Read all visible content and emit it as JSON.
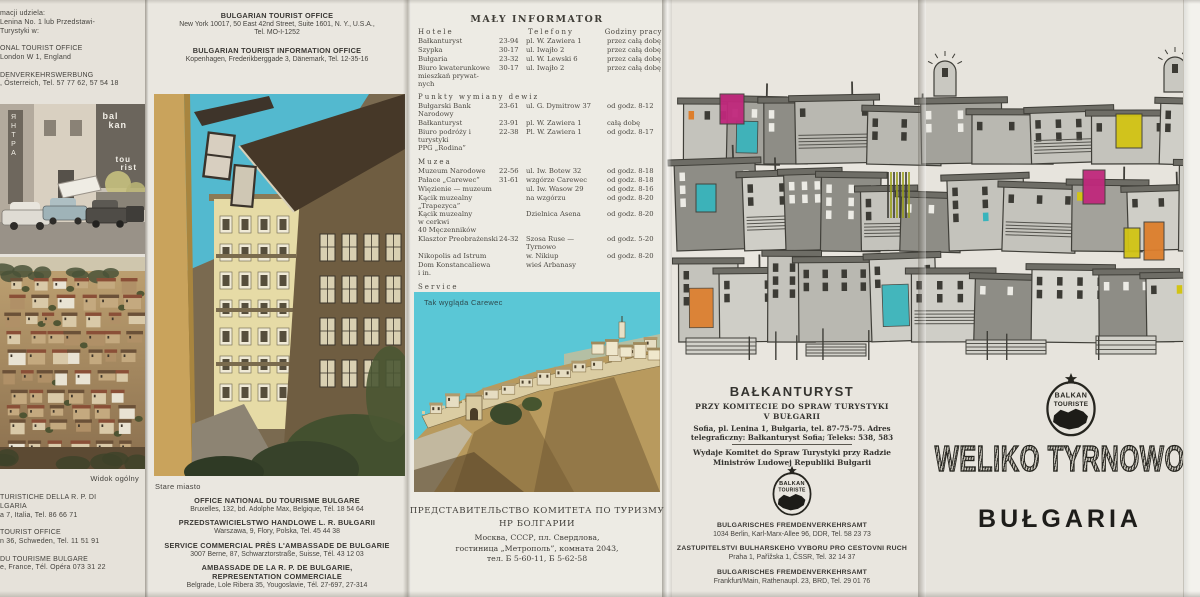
{
  "colors": {
    "paper": "#e8e5de",
    "ink": "#44423d",
    "magenta": "#c0287c",
    "yellow": "#d2c414",
    "orange": "#dd7e2c",
    "teal": "#38b4bc",
    "sky": "#58c5d4",
    "street_sky": "#53b9cf"
  },
  "logo": {
    "top": "BALKAN",
    "bottom": "TOURISTE"
  },
  "panel1": {
    "top_block": "macji udziela:\nLenina No. 1 lub Przedstawi-\nTurystyki w:\n\nONAL TOURIST OFFICE\nLondon W 1, England\n\nDENVERKEHRSWERBUNG\n, Österreich, Tel. 57 77 62, 57 54 18",
    "hotel_sign": {
      "vertical": "ЯНТРА",
      "line1": "bal",
      "line2": "kan",
      "line3": "tou",
      "line4": "rist"
    },
    "caption": "Widok ogólny",
    "bottom_block": "TURISTICHE DELLA R. P. DI\nLGARIA\na 7, Italia, Tel. 86 66 71\n\nTOURIST OFFICE\nn 36, Schweden, Tel. 11 51 91\n\nDU TOURISME BULGARE\ne, France, Tél. Opéra 073 31 22"
  },
  "panel2": {
    "top_offices": [
      {
        "title": "BULGARIAN TOURIST OFFICE",
        "lines": "New York 10017, 50 East 42nd Street, Suite 1601, N. Y., U.S.A.,\nTel. MO-I-1252"
      },
      {
        "title": "BULGARIAN TOURIST INFORMATION OFFICE",
        "lines": "Kopenhagen, Frederikberggade 3, Dänemark, Tel. 12-35-16"
      }
    ],
    "caption": "Stare miasto",
    "bottom_offices": [
      {
        "title": "OFFICE NATIONAL DU TOURISME BULGARE",
        "lines": "Bruxelles, 132, bd. Adolphe Max, Belgique, Tél. 18 54 64"
      },
      {
        "title": "PRZEDSTAWICIELSTWO HANDLOWE L. R. BUŁGARII",
        "lines": "Warszawa, 9, Flory, Polska, Tel. 45 44 38"
      },
      {
        "title": "SERVICE COMMERCIAL PRÈS L'AMBASSADE DE BULGARIE",
        "lines": "3007 Berne, 87, Schwarztorstraße, Suisse, Tél. 43 12 03"
      },
      {
        "title": "AMBASSADE DE LA R. P. DE BULGARIE,\nREPRESENTATION COMMERCIALE",
        "lines": "Belgrade, Lole Ribera 35, Yougoslavie, Tél. 27-697, 27-314"
      }
    ]
  },
  "informator": {
    "title": "MAŁY INFORMATOR",
    "header": {
      "c1": "Hotele",
      "c2": "Telefony",
      "c3": "Godziny pracy"
    },
    "sections": [
      {
        "title": "",
        "rows": [
          [
            "Bałkanturyst",
            "23-94",
            "pl. W. Zawiera 1",
            "przez całą dobę"
          ],
          [
            "Szypka",
            "30-17",
            "ul. Iwajło 2",
            "przez całą dobę"
          ],
          [
            "Bułgaria",
            "23-32",
            "ul. W. Lewski 6",
            "przez całą dobę"
          ],
          [
            "Biuro kwaterunkowe\nmieszkań prywat-\nnych",
            "30-17",
            "ul. Iwajło 2",
            "przez całą dobę"
          ]
        ]
      },
      {
        "title": "Punkty wymiany dewiz",
        "rows": [
          [
            "Bułgarski Bank\nNarodowy",
            "23-61",
            "ul. G. Dymitrow 37",
            "od godz. 8-12"
          ],
          [
            "Bałkanturyst",
            "23-91",
            "pl. W. Zawiera 1",
            "całą dobę"
          ],
          [
            "Biuro podróży i\nturystyki\nPPG „Rodina”",
            "22-38",
            "Pl. W. Zawiera 1",
            "od godz. 8-17"
          ]
        ]
      },
      {
        "title": "Muzea",
        "rows": [
          [
            "Muzeum Narodowe",
            "22-56",
            "ul. Iw. Botew 32",
            "od godz. 8-18"
          ],
          [
            "Pałace „Carewec”",
            "31-61",
            "wzgórze Carewec",
            "od godz. 8-18"
          ],
          [
            "Więzienie — muzeum",
            "",
            "ul. Iw. Wasow 29",
            "od godz. 8-16"
          ],
          [
            "Kącik muzealny\n„Trapezyca”",
            "",
            "na wzgórzu",
            "od godz. 8-20"
          ],
          [
            "Kącik muzealny\nw cerkwi\n40 Męczenników",
            "",
            "Dzielnica Asena",
            "od godz. 8-20"
          ],
          [
            "Klasztor Preobrażenski",
            "24-32",
            "Szosa Ruse —\nTyrnowo",
            "od godz. 5-20"
          ],
          [
            "Nikopolis ad Istrum",
            "",
            "w. Nikiup",
            "od godz. 8-20"
          ],
          [
            "Dom Konstancaliewa\ni in.",
            "",
            "wieś Arbanasy",
            ""
          ]
        ]
      },
      {
        "title": "Service",
        "rows": [
          [
            "Autoservice „Rodina”",
            "",
            "na szosie Sofia —\nWarna",
            "od godz. 8-18"
          ],
          [
            "Service remontowy",
            "25-07",
            "ul. Christo Botew 76",
            "od godz. 8-17"
          ]
        ]
      }
    ]
  },
  "panel3": {
    "photo_caption": "Tak wygląda Carewec",
    "russian": {
      "h1": "ПРЕДСТАВИТЕЛЬСТВО КОМИТЕТА ПО ТУРИЗМУ",
      "h2": "НР БОЛГАРИИ",
      "body": "Москва, СССР, пл. Свердлова,\nгостиница „Метрополь”, комната 2043,\nтел. Б 5-60-11, Б 5-62-58"
    }
  },
  "panel4": {
    "title": "BAŁKANTURYST",
    "sub": "PRZY KOMITECIE DO SPRAW TURYSTYKI\nV BUŁGARII",
    "addr": "Sofia, pl. Lenina 1, Bułgaria, tel. 87-75-75. Adres\ntelegraficzny: Bałkanturyst Sofia; Teleks: 538, 583",
    "publisher": "Wydaje Komitet do Spraw Turystyki przy Radzie\nMinistrów Ludowej Republiki Bułgarii",
    "offices": [
      {
        "title": "BULGARISCHES FREMDENVERKEHRSAMT",
        "lines": "1034 Berlin, Karl-Marx-Allee 96, DDR, Tel. 58 23 73"
      },
      {
        "title": "ZASTUPITELSTVI BULHARSKEHO VYBORU PRO CESTOVNI RUCH",
        "lines": "Praha 1, Pařížska 1, ČSSR, Tel. 32 14 37"
      },
      {
        "title": "BULGARISCHES FREMDENVERKEHRSAMT",
        "lines": "Frankfurt/Main, Rathenaupl. 23, BRD, Tel. 29 01 76"
      }
    ]
  },
  "panel5": {
    "title": "WELIKO TYRNOWO",
    "subtitle": "BUŁGARIA"
  }
}
